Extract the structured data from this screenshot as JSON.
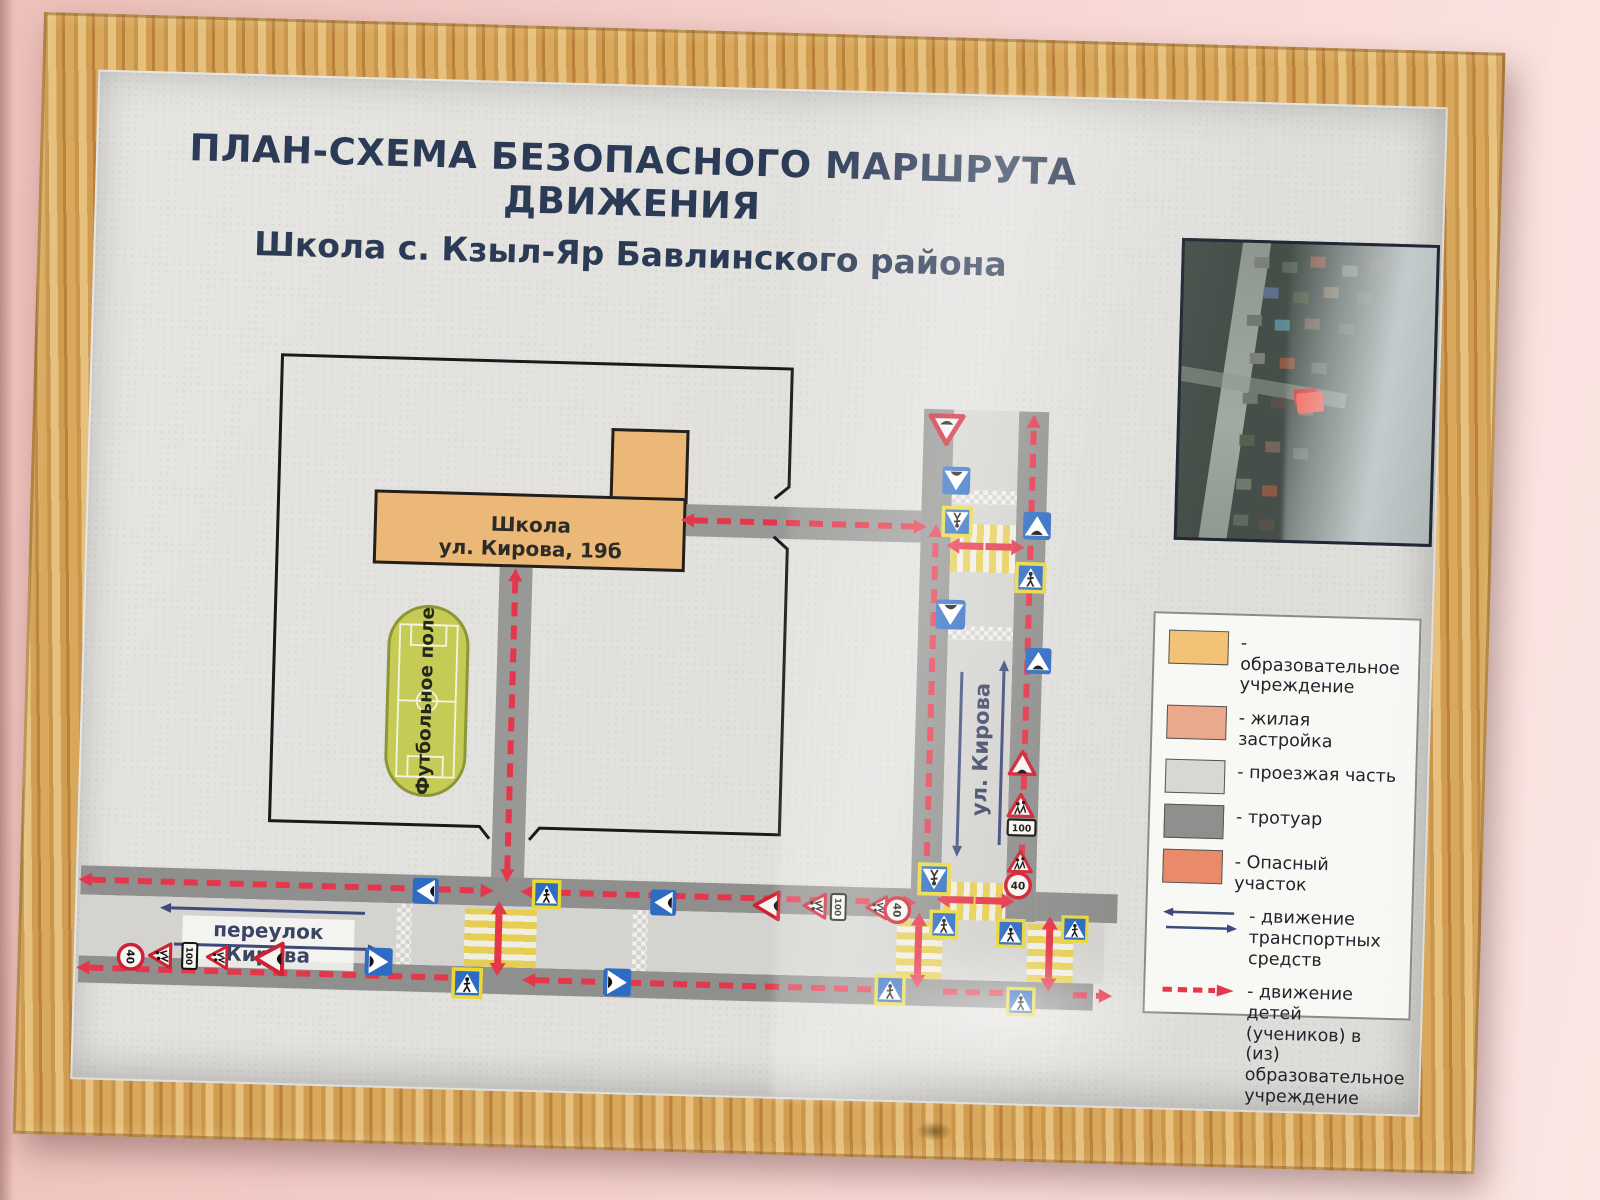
{
  "title": {
    "line1": "ПЛАН-СХЕМА БЕЗОПАСНОГО МАРШРУТА ДВИЖЕНИЯ",
    "line2": "Школа с. Кзыл-Яр Бавлинского района"
  },
  "map": {
    "school_label1": "Школа",
    "school_label2": "ул. Кирова, 19б",
    "field_label": "Футбольное поле",
    "street_v": "ул. Кирова",
    "street_h": "переулок  Кирова",
    "sign_40": "40",
    "sign_100": "100",
    "roads": [
      {
        "x": 865,
        "y": 316,
        "w": 65,
        "h": 510,
        "k": "way"
      },
      {
        "x": 835,
        "y": 316,
        "w": 30,
        "h": 510,
        "k": "walk"
      },
      {
        "x": 930,
        "y": 316,
        "w": 30,
        "h": 510,
        "k": "walk"
      },
      {
        "x": 5,
        "y": 825,
        "w": 1025,
        "h": 61,
        "k": "way"
      },
      {
        "x": 5,
        "y": 796,
        "w": 830,
        "h": 29,
        "k": "walk"
      },
      {
        "x": 960,
        "y": 796,
        "w": 82,
        "h": 29,
        "k": "walk"
      },
      {
        "x": 5,
        "y": 886,
        "w": 1015,
        "h": 27,
        "k": "walk"
      },
      {
        "x": 415,
        "y": 482,
        "w": 33,
        "h": 314,
        "k": "path"
      },
      {
        "x": 600,
        "y": 418,
        "w": 265,
        "h": 32,
        "k": "path"
      }
    ],
    "zebras": [
      {
        "x": 865,
        "y": 430,
        "w": 65,
        "h": 48,
        "d": "v"
      },
      {
        "x": 868,
        "y": 788,
        "w": 62,
        "h": 38,
        "d": "v"
      },
      {
        "x": 390,
        "y": 828,
        "w": 72,
        "h": 58,
        "d": "h"
      },
      {
        "x": 822,
        "y": 828,
        "w": 46,
        "h": 58,
        "d": "h"
      },
      {
        "x": 953,
        "y": 828,
        "w": 46,
        "h": 58,
        "d": "h"
      }
    ],
    "checkers": [
      {
        "x": 865,
        "y": 396,
        "w": 65,
        "h": 14
      },
      {
        "x": 865,
        "y": 532,
        "w": 65,
        "h": 14
      },
      {
        "x": 322,
        "y": 825,
        "w": 15,
        "h": 61
      },
      {
        "x": 558,
        "y": 825,
        "w": 15,
        "h": 61
      }
    ],
    "routes": [
      {
        "x1": 16,
        "y1": 810,
        "x2": 405,
        "y2": 810,
        "a1": 1,
        "a2": 1
      },
      {
        "x1": 458,
        "y1": 810,
        "x2": 828,
        "y2": 810,
        "a1": 1,
        "a2": 1
      },
      {
        "x1": 16,
        "y1": 898,
        "x2": 386,
        "y2": 898,
        "a1": 1,
        "a2": 1
      },
      {
        "x1": 462,
        "y1": 898,
        "x2": 818,
        "y2": 898,
        "a1": 1,
        "a2": 0
      },
      {
        "x1": 870,
        "y1": 898,
        "x2": 950,
        "y2": 898,
        "a1": 0,
        "a2": 0
      },
      {
        "x1": 1000,
        "y1": 898,
        "x2": 1026,
        "y2": 898,
        "a1": 0,
        "a2": 1
      },
      {
        "x1": 431,
        "y1": 788,
        "x2": 431,
        "y2": 500,
        "a1": 1,
        "a2": 1
      },
      {
        "x1": 608,
        "y1": 434,
        "x2": 828,
        "y2": 434,
        "a1": 1,
        "a2": 1
      },
      {
        "x1": 850,
        "y1": 786,
        "x2": 850,
        "y2": 444,
        "a1": 0,
        "a2": 1
      },
      {
        "x1": 945,
        "y1": 786,
        "x2": 945,
        "y2": 332,
        "a1": 0,
        "a2": 1
      }
    ],
    "solids": [
      {
        "x1": 898,
        "y1": 452,
        "x2": 874,
        "y2": 452
      },
      {
        "x1": 900,
        "y1": 452,
        "x2": 926,
        "y2": 452
      },
      {
        "x1": 898,
        "y1": 806,
        "x2": 874,
        "y2": 806
      },
      {
        "x1": 900,
        "y1": 806,
        "x2": 926,
        "y2": 806
      },
      {
        "x1": 424,
        "y1": 857,
        "x2": 424,
        "y2": 833
      },
      {
        "x1": 424,
        "y1": 857,
        "x2": 424,
        "y2": 882
      },
      {
        "x1": 844,
        "y1": 857,
        "x2": 844,
        "y2": 833
      },
      {
        "x1": 844,
        "y1": 857,
        "x2": 844,
        "y2": 882
      },
      {
        "x1": 975,
        "y1": 857,
        "x2": 975,
        "y2": 833
      },
      {
        "x1": 975,
        "y1": 857,
        "x2": 975,
        "y2": 882
      }
    ],
    "blues": [
      {
        "x1": 290,
        "y1": 836,
        "x2": 96,
        "y2": 836
      },
      {
        "x1": 100,
        "y1": 872,
        "x2": 294,
        "y2": 872
      },
      {
        "x1": 880,
        "y1": 578,
        "x2": 880,
        "y2": 752
      },
      {
        "x1": 922,
        "y1": 750,
        "x2": 922,
        "y2": 576
      }
    ],
    "territory_path": "M412,758 L402,746 L192,746 L192,280 L702,280 L702,398 L688,410 M688,448 L702,460 L702,746 L462,746 L452,758",
    "signs": [
      {
        "t": "yield",
        "x": 858,
        "y": 336,
        "s": 38
      },
      {
        "t": "hump",
        "x": 869,
        "y": 387,
        "s": 30,
        "r": 180
      },
      {
        "t": "ped",
        "x": 871,
        "y": 428,
        "s": 32,
        "r": 180,
        "yb": 1
      },
      {
        "t": "hump",
        "x": 867,
        "y": 521,
        "s": 32,
        "r": 180
      },
      {
        "t": "ped",
        "x": 858,
        "y": 786,
        "s": 34,
        "r": 180,
        "yb": 1
      },
      {
        "t": "hump",
        "x": 951,
        "y": 430,
        "s": 30
      },
      {
        "t": "ped",
        "x": 946,
        "y": 482,
        "s": 32,
        "yb": 1
      },
      {
        "t": "hump",
        "x": 956,
        "y": 565,
        "s": 28
      },
      {
        "t": "humpw",
        "x": 943,
        "y": 668,
        "s": 30
      },
      {
        "t": "child",
        "x": 942,
        "y": 710,
        "s": 29
      },
      {
        "t": "p100",
        "x": 944,
        "y": 732,
        "s": 30
      },
      {
        "t": "child",
        "x": 943,
        "y": 766,
        "s": 27
      },
      {
        "t": "lim40",
        "x": 942,
        "y": 790,
        "s": 28
      },
      {
        "t": "hump",
        "x": 350,
        "y": 812,
        "s": 28,
        "r": -90
      },
      {
        "t": "hump",
        "x": 588,
        "y": 817,
        "s": 28,
        "r": -90
      },
      {
        "t": "humpw",
        "x": 692,
        "y": 817,
        "s": 32,
        "r": -90
      },
      {
        "t": "child",
        "x": 740,
        "y": 816,
        "s": 28,
        "r": -90
      },
      {
        "t": "p100",
        "x": 763,
        "y": 816,
        "s": 28,
        "r": 90
      },
      {
        "t": "child",
        "x": 802,
        "y": 816,
        "s": 26,
        "r": -90
      },
      {
        "t": "lim40",
        "x": 822,
        "y": 818,
        "s": 28,
        "r": 90
      },
      {
        "t": "ped",
        "x": 869,
        "y": 831,
        "s": 30,
        "yb": 1
      },
      {
        "t": "ped",
        "x": 817,
        "y": 898,
        "s": 32,
        "yb": 1
      },
      {
        "t": "ped",
        "x": 936,
        "y": 838,
        "s": 30,
        "yb": 1
      },
      {
        "t": "ped",
        "x": 1000,
        "y": 832,
        "s": 28,
        "yb": 1
      },
      {
        "t": "ped",
        "x": 948,
        "y": 906,
        "s": 30,
        "yb": 1
      },
      {
        "t": "ped",
        "x": 471,
        "y": 812,
        "s": 30,
        "yb": 1
      },
      {
        "t": "ped",
        "x": 394,
        "y": 903,
        "s": 32,
        "yb": 1
      },
      {
        "t": "lim40",
        "x": 57,
        "y": 886,
        "s": 28,
        "r": 90
      },
      {
        "t": "child",
        "x": 87,
        "y": 884,
        "s": 28,
        "r": -90
      },
      {
        "t": "p100",
        "x": 116,
        "y": 883,
        "s": 28,
        "r": 90
      },
      {
        "t": "child",
        "x": 144,
        "y": 884,
        "s": 26,
        "r": -90
      },
      {
        "t": "humpw",
        "x": 196,
        "y": 884,
        "s": 36,
        "r": -90
      },
      {
        "t": "hump",
        "x": 305,
        "y": 884,
        "s": 30,
        "r": 90
      },
      {
        "t": "hump",
        "x": 544,
        "y": 898,
        "s": 30,
        "r": 90
      }
    ]
  },
  "legend": {
    "items": [
      {
        "kind": "swatch",
        "color": "#f2c377",
        "label": "- образовательное учреждение"
      },
      {
        "kind": "swatch",
        "color": "#eba98b",
        "label": "- жилая застройка"
      },
      {
        "kind": "swatch",
        "color": "#d8d7d3",
        "label": "- проезжая часть"
      },
      {
        "kind": "swatch",
        "color": "#8f8f8d",
        "label": "- тротуар"
      },
      {
        "kind": "swatch",
        "color": "#e98a6a",
        "label": "- Опасный участок"
      },
      {
        "kind": "traffic",
        "label": "- движение транспортных средств"
      },
      {
        "kind": "route",
        "label": "- движение детей (учеников) в (из) образовательное учреждение"
      }
    ]
  },
  "colors": {
    "route_red": "#e4374b",
    "traffic_blue": "#3e4b7a",
    "sign_blue": "#2e6cc3",
    "sign_red": "#cf2233",
    "sign_yellow": "#e9d73c",
    "title_navy": "#2b3a55"
  }
}
